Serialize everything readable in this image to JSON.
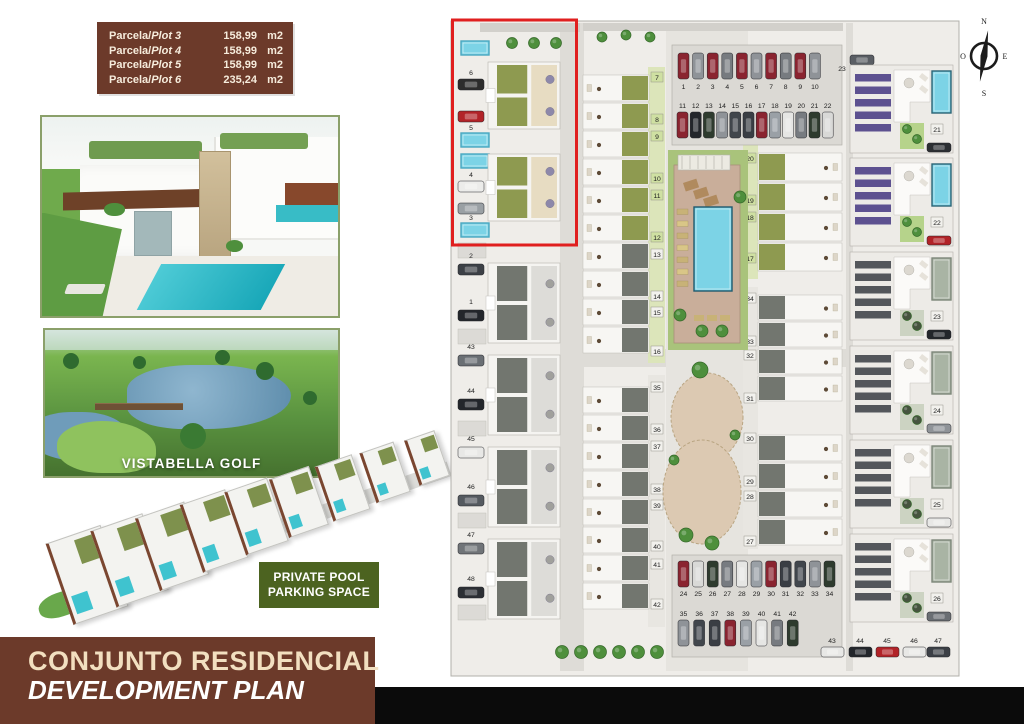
{
  "plot_table": {
    "rows": [
      {
        "prefix": "Parcela/",
        "plot": "Plot 3",
        "area": "158,99",
        "unit": "m2"
      },
      {
        "prefix": "Parcela/",
        "plot": "Plot 4",
        "area": "158,99",
        "unit": "m2"
      },
      {
        "prefix": "Parcela/",
        "plot": "Plot 5",
        "area": "158,99",
        "unit": "m2"
      },
      {
        "prefix": "Parcela/",
        "plot": "Plot 6",
        "area": "235,24",
        "unit": "m2"
      }
    ]
  },
  "golf_caption": "VISTABELLA GOLF",
  "badge": {
    "line1": "PRIVATE POOL",
    "line2": "PARKING SPACE"
  },
  "footer": {
    "line1": "CONJUNTO RESIDENCIAL",
    "line2": "DEVELOPMENT PLAN"
  },
  "compass": {
    "north": "N",
    "south": "S",
    "east": "E",
    "west": "O"
  },
  "site_plan": {
    "highlight_lane": [
      "6",
      "5",
      "4",
      "3"
    ],
    "left_lane": [
      "2",
      "1",
      "43",
      "44",
      "45",
      "46",
      "47",
      "48"
    ],
    "col2_units": [
      "7",
      "8",
      "9",
      "10",
      "11",
      "12",
      "13",
      "14",
      "15",
      "16"
    ],
    "col2_units_lower": [
      "35",
      "36",
      "37",
      "38",
      "39",
      "40",
      "41",
      "42"
    ],
    "col3_units": [
      "20",
      "19",
      "18",
      "17"
    ],
    "col3_units_lower": [
      "34",
      "33",
      "32",
      "31",
      "30",
      "29",
      "28",
      "27"
    ],
    "villas": [
      "21",
      "22",
      "23",
      "24",
      "25",
      "26"
    ],
    "parking_top_a": [
      "1",
      "2",
      "3",
      "4",
      "5",
      "6",
      "7",
      "8",
      "9",
      "10"
    ],
    "parking_top_b": [
      "11",
      "12",
      "13",
      "14",
      "15",
      "16",
      "17",
      "18",
      "19",
      "20",
      "21",
      "22"
    ],
    "parking_top_right": "23",
    "parking_bottom_a": [
      "24",
      "25",
      "26",
      "27",
      "28",
      "29",
      "30",
      "31",
      "32",
      "33",
      "34"
    ],
    "parking_bottom_b": [
      "35",
      "36",
      "37",
      "38",
      "39",
      "40",
      "41",
      "42"
    ],
    "parking_bottom_edge": [
      "43",
      "44",
      "45",
      "46",
      "47"
    ]
  },
  "colors": {
    "brown": "#6c3a2a",
    "cream": "#f2dfc0",
    "badge_green": "#4c6320",
    "highlight_red": "#e01f1f",
    "pool_cyan": "#7cd3e6",
    "garden_green": "#8e9a50",
    "garden_grey": "#72766f",
    "purple": "#5d5190",
    "photo_border": "#8ba06a"
  }
}
